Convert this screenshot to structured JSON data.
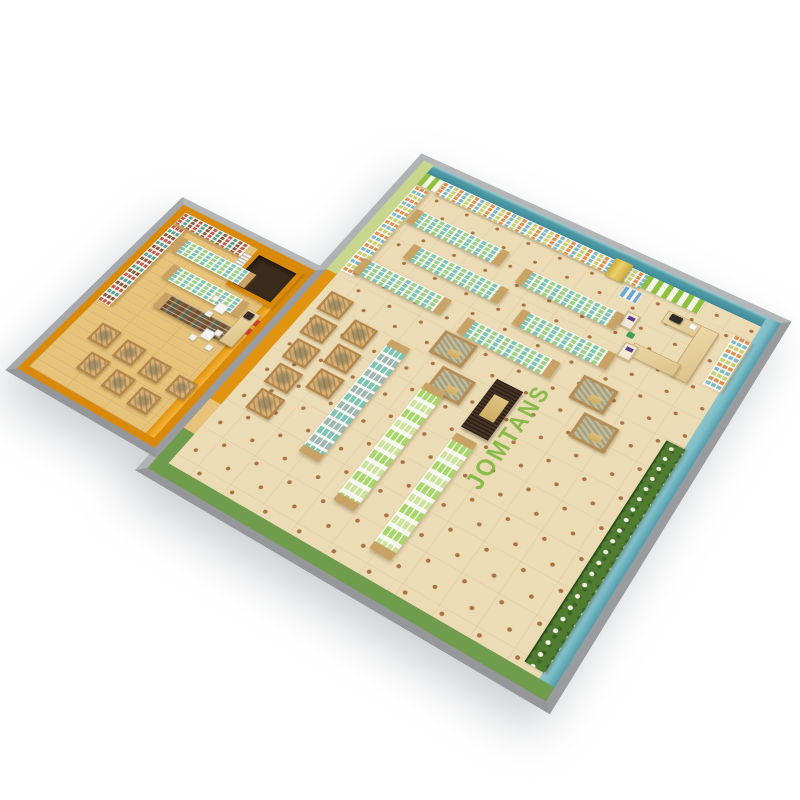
{
  "scene": {
    "description": "3D isometric render of a supermarket store floor plan",
    "floor_decal": "JOMTANS",
    "rooms": [
      {
        "name": "main-sales-floor",
        "floor": "cream tile with brown dot grid",
        "walls": {
          "north": "teal accent wall with full-length wall shelving",
          "north_east_section": "green and white striped wallpaper behind checkout",
          "east": "teal wall with wall shelf and plant display",
          "south": "green painted wall",
          "west": "light green wall with shelving, orange partition to annex"
        }
      },
      {
        "name": "annex-room",
        "floor": "light wood planks",
        "walls": "orange painted walls with wall shelving and enclosed storage room"
      }
    ],
    "fixtures": {
      "wall_shelving_runs": 5,
      "island_gondolas": 9,
      "long_gondolas": 3,
      "dark_wine_gondola": 1,
      "wooden_crate_displays": 14,
      "pallet_display_tables": 4,
      "dark_display_table": 1,
      "checkout_counter": 1,
      "checkout_stands": 2,
      "cash_register": 1,
      "scale_appliance": 1,
      "storage_room": 1,
      "coffee_machine": 1,
      "cafe_tables": 2,
      "cafe_chairs": 5,
      "plant_flower_wall": 1,
      "yellow_column": 1,
      "shopping_basket": 1
    }
  },
  "colors": {
    "wall_gray": "#a7a9ab",
    "teal": "#3f8c99",
    "teal_light": "#7fbfc9",
    "orange": "#f2a51c",
    "orange_deep": "#d98a0b",
    "orange_face": "#e0940f",
    "green_wall": "#6f9c4d",
    "lt_green_wall": "#c9d68e",
    "stripe_green": "#8fc13f",
    "floor_tile": "#ecdcb6",
    "floor_dot": "#a87443",
    "wood": "#e7c279",
    "wood_dark": "#c9a265",
    "shelf_white": "#f6f5f0",
    "product_teal": "#7fc4b2",
    "product_mint": "#9ecf86",
    "product_green": "#a8d66a",
    "plant": "#4f7c31",
    "decal": "#7fb840",
    "dark_table": "#473425",
    "sign_purple": "#5b3c8f",
    "register": "#2e2b28",
    "red_sign": "#cf3b2a"
  }
}
